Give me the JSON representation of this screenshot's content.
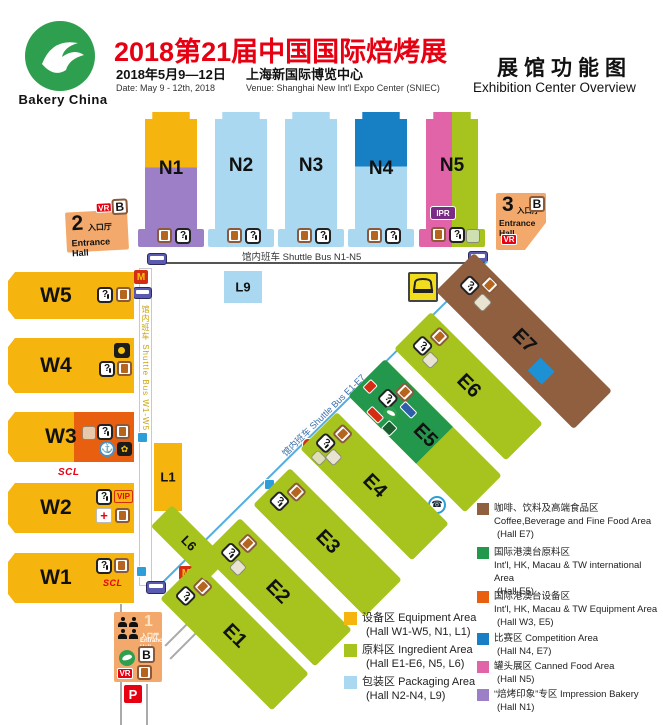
{
  "header": {
    "brand": "Bakery China",
    "title": "2018第21届中国国际焙烤展",
    "date_zh": "2018年5月9—12日",
    "date_en": "Date: May 9 - 12th, 2018",
    "venue_zh": "上海新国际博览中心",
    "venue_en": "Venue: Shanghai New Int'l Expo Center (SNIEC)",
    "overview_zh": "展馆功能图",
    "overview_en": "Exhibition Center Overview"
  },
  "halls": {
    "n1": "N1",
    "n2": "N2",
    "n3": "N3",
    "n4": "N4",
    "n5": "N5",
    "w1": "W1",
    "w2": "W2",
    "w3": "W3",
    "w4": "W4",
    "w5": "W5",
    "e1": "E1",
    "e2": "E2",
    "e3": "E3",
    "e4": "E4",
    "e5": "E5",
    "e6": "E6",
    "e7": "E7",
    "l1": "L1",
    "l6": "L6",
    "l9": "L9"
  },
  "entrances": {
    "hall1": {
      "num": "1",
      "label_zh": "入口厅",
      "label_en": "Entrance Hall"
    },
    "hall2": {
      "num": "2",
      "label_zh": "入口厅",
      "label_en": "Entrance Hall"
    },
    "hall3": {
      "num": "3",
      "label_zh": "入口厅",
      "label_en": "Entrance Hall"
    }
  },
  "shuttle": {
    "n": "馆内班车 Shuttle Bus N1-N5",
    "w": "馆内班车 Shuttle Bus W1-W5",
    "e": "馆内班车 Shuttle Bus E1-E7"
  },
  "badges": {
    "vr": "VR",
    "b": "B",
    "p": "P",
    "ipr": "IPR",
    "vip": "VIP",
    "scl": "SCL",
    "mcdonalds": "M",
    "question": "?",
    "cross": "+",
    "phone": "☎",
    "anchor": "⚓",
    "flower": "✿"
  },
  "legend_left": [
    {
      "zh": "设备区",
      "en": "Equipment Area",
      "halls": "(Hall W1-W5, N1, L1)",
      "color": "#F5B40E"
    },
    {
      "zh": "原料区",
      "en": "Ingredient Area",
      "halls": "(Hall E1-E6, N5, L6)",
      "color": "#A6C41D"
    },
    {
      "zh": "包装区",
      "en": "Packaging Area",
      "halls": "(Hall N2-N4, L9)",
      "color": "#AAD8F0"
    }
  ],
  "legend_right": [
    {
      "zh": "咖啡、饮料及高端食品区",
      "en": "Coffee,Beverage and Fine Food Area",
      "halls": "(Hall E7)",
      "color": "#8F5F40"
    },
    {
      "zh": "国际港澳台原料区",
      "en": "Int'l, HK, Macau & TW international Area",
      "halls": "(Hall E5)",
      "color": "#23984C"
    },
    {
      "zh": "国际港澳台设备区",
      "en": "Int'l, HK, Macau & TW Equipment Area",
      "halls": "(Hall W3, E5)",
      "color": "#E8600F"
    },
    {
      "zh": "比赛区 Competition Area",
      "en": "",
      "halls": "(Hall N4, E7)",
      "color": "#1780C4"
    },
    {
      "zh": "罐头展区 Canned Food Area",
      "en": "",
      "halls": "(Hall N5)",
      "color": "#E164A8"
    },
    {
      "zh": "“焙烤印象”专区 Impression Bakery",
      "en": "",
      "halls": "(Hall N1)",
      "color": "#9C7FC6"
    }
  ],
  "colors": {
    "equipment": "#F5B40E",
    "ingredient": "#A6C41D",
    "packaging": "#AAD8F0",
    "coffee": "#8F5F40",
    "intl_ingredient": "#23984C",
    "intl_equipment": "#E8600F",
    "competition": "#1780C4",
    "canned": "#E164A8",
    "impression": "#9C7FC6",
    "accent_red": "#E60012",
    "shuttle_line": "#52AEE0",
    "entrance": "#F2A96B"
  }
}
